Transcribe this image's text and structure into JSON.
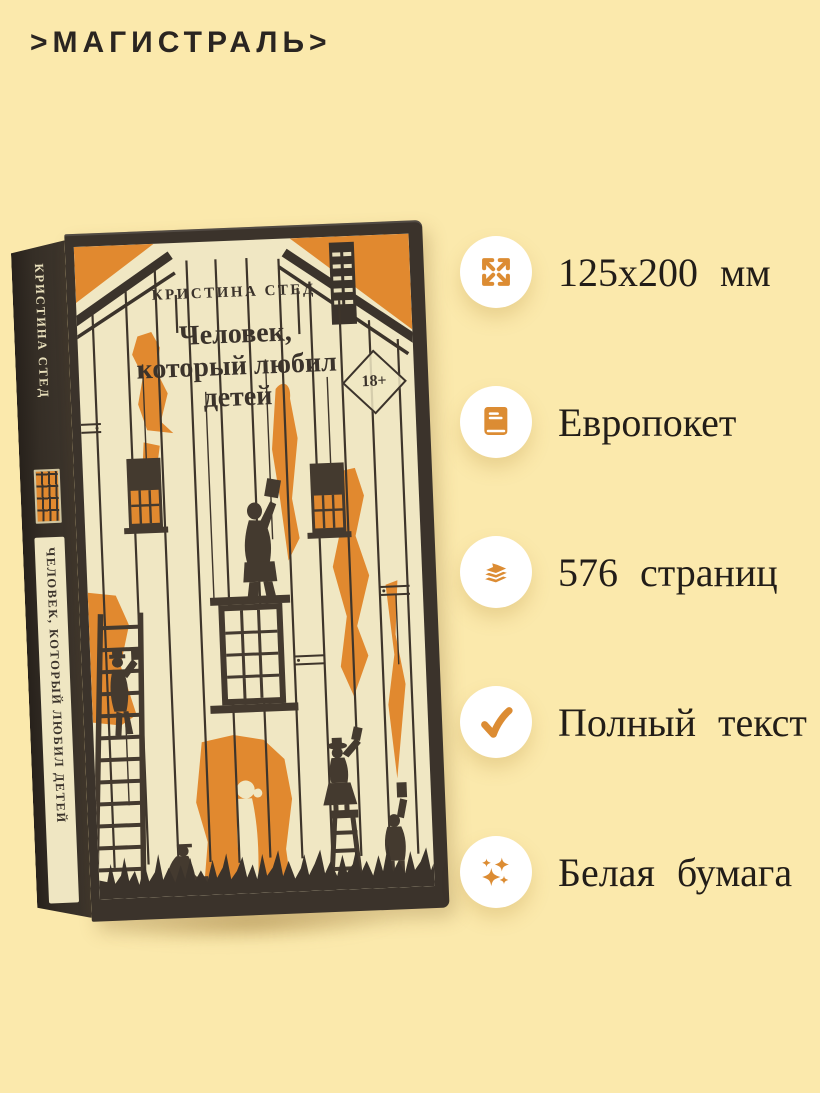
{
  "page": {
    "background_color": "#FBE9AC"
  },
  "logo": {
    "text": ">МАГИСТРАЛЬ>"
  },
  "book": {
    "spine": {
      "author": "КРИСТИНА СТЕД",
      "title": "ЧЕЛОВЕК, КОТОРЫЙ ЛЮБИЛ ДЕТЕЙ"
    },
    "cover": {
      "author": "КРИСТИНА СТЕД",
      "title_lines": [
        "Человек,",
        "который любил",
        "детей"
      ],
      "age_badge": "18+"
    },
    "colors": {
      "cover_cream": "#F0E7C3",
      "paint_orange": "#E1892F",
      "silhouette_dark": "#443A2F",
      "frame_dark": "#3B332B"
    }
  },
  "features": [
    {
      "icon": "expand-icon",
      "label": "125x200 мм"
    },
    {
      "icon": "book-icon",
      "label": "Европокет"
    },
    {
      "icon": "pages-icon",
      "label": "576 страниц"
    },
    {
      "icon": "check-icon",
      "label": "Полный текст"
    },
    {
      "icon": "sparkles-icon",
      "label": "Белая бумага"
    }
  ],
  "accent": {
    "icon_orange": "#DC8C33",
    "text_dark": "#221D18",
    "icon_circle": "#FFFFFF",
    "background": "#FBE9AC"
  }
}
